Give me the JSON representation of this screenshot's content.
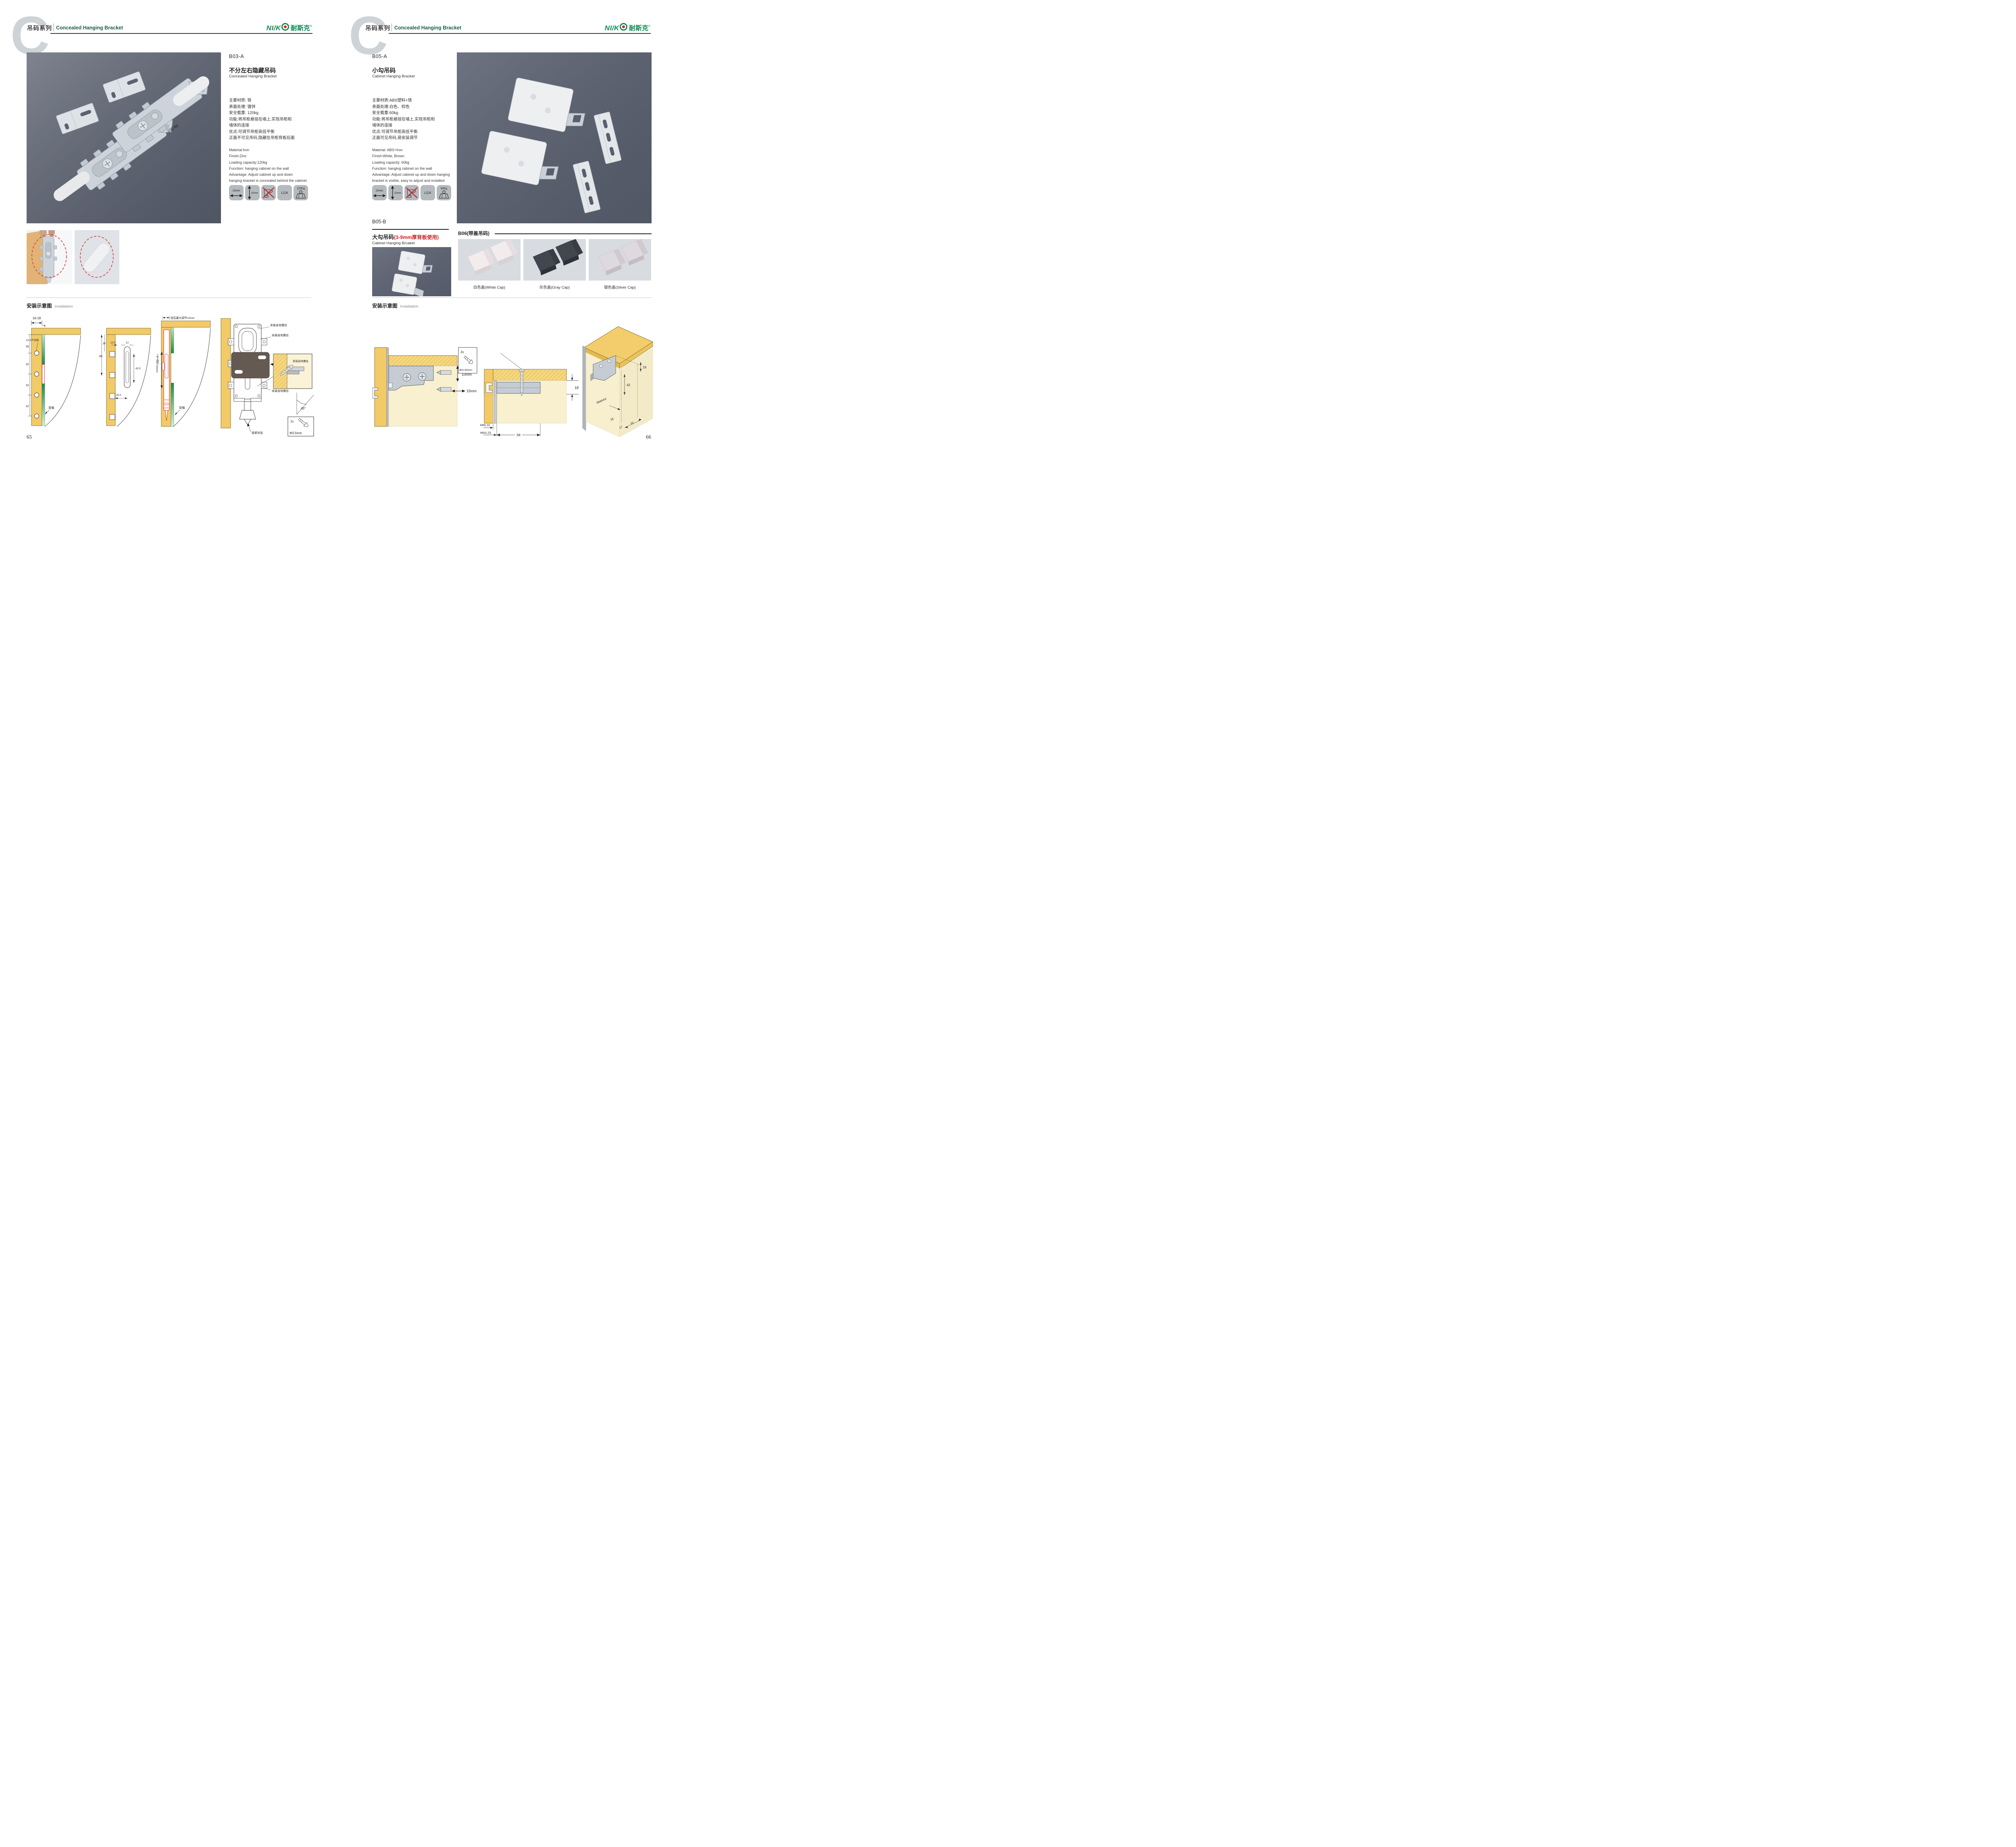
{
  "header": {
    "letter": "C",
    "series_cn": "吊码系列",
    "series_en": "Concealed Hanging Bracket"
  },
  "brand": {
    "part_ni": "NI",
    "part_slash": "/",
    "part_k": "K",
    "part_cn": "耐斯克",
    "reg": "®"
  },
  "left_page": {
    "page_number": "65",
    "product": {
      "code": "B03-A",
      "name_cn": "不分左右隐藏吊码",
      "name_en": "Concealed Hanging Bracket",
      "specs_cn": [
        "主要材质: 铁",
        "表面处理: 镀锌",
        "安全载重: 120kg",
        "功能:将吊柜悬挂在墙上,实现吊柜和",
        "墙体的连接",
        "优点:可调节吊柜高低平衡",
        "正面不可见吊码,隐藏在吊柜背板后面"
      ],
      "specs_en": [
        "Material:Iron",
        "Finish:Zinc",
        "Loading capacity:120kg",
        "Function: hanging cabinet on the wall",
        "Advantage: Adjust cabinet up and down",
        "hanging bracket is concealed behind the cabinet"
      ],
      "photo_stamp": "100 kg"
    },
    "icons": {
      "width_label": "10mm",
      "height_label": "10mm",
      "lga_label": "LGA",
      "load_label": "120Kg"
    },
    "installation": {
      "title_cn": "安装示意图",
      "title_en": "Installation",
      "d1": {
        "dim_top": "16-18",
        "dim_5": "5",
        "dims_left": [
          "35",
          "32",
          "32",
          "32"
        ],
        "callout": "10-4个均布",
        "back_panel": "背板"
      },
      "d2": {
        "dim_60": "60",
        "dim_35": "35",
        "dim_125": "12.5",
        "dim_12": "12",
        "dim_425": "42.5",
        "dim_205": "20.5"
      },
      "d3": {
        "top_label": "前后最大调节10mm",
        "side_label": "上下调节10mm",
        "back_panel": "背板"
      },
      "d4": {
        "screw_label_1": "安装自攻螺丝",
        "screw_label_2": "安装自攻螺丝",
        "screw_label_3": "安装自攻螺丝",
        "plate_label": "专用挂片",
        "lock_label": "锁紧状态",
        "detail_label": "安装自攻螺丝",
        "angle": "45°",
        "qty": "1x",
        "size": "Φ3.5mm"
      }
    }
  },
  "right_page": {
    "page_number": "66",
    "product_a": {
      "code": "B05-A",
      "name_cn": "小勾吊码",
      "name_en": "Cabinet Hanging Bracket",
      "specs_cn": [
        "主要材质:ABS塑料+铁",
        "表面处理:白色、棕色",
        "安全载重:60kg",
        "功能:将吊柜悬挂在墙上,实现吊柜和",
        "墙体的连接",
        "优点:可调节吊柜高低平衡",
        "正面可见吊码,易安装调节"
      ],
      "specs_en": [
        "Material: ABS+Iron",
        "Finish:White, Brown",
        "Loading capacity: 60kg",
        "Function: hanging cabinet on the wall",
        "Advantage: Adjust cabinet up and down hanging",
        "bracket is visible, easy to adjust and installed"
      ]
    },
    "icons": {
      "width_label": "15mm",
      "height_label": "10mm",
      "lga_label": "LGA",
      "load_label": "60Kg"
    },
    "product_b": {
      "code": "B05-B",
      "name_cn": "大勾吊码",
      "name_note": "(3-9mm厚背板使用)",
      "name_en": "Cabinet Hanging Brcaket"
    },
    "product_b06": {
      "label": "B06(带盖吊码)",
      "caps": [
        {
          "label": "白色盖(White Cap)"
        },
        {
          "label": "灰色盖(Gray Cap)"
        },
        {
          "label": "银色盖(Silver Cap)"
        }
      ]
    },
    "installation": {
      "title_cn": "安装示意图",
      "title_en": "Installation",
      "d1": {
        "qty": "2x",
        "size": "Φ4×30mm",
        "v_adjust": "10mm",
        "h_adjust": "15mm"
      },
      "d2": {
        "dim_18": "18",
        "dim_min": "MIN.10",
        "dim_max": "MAX.23",
        "dim_58": "58"
      },
      "d3": {
        "dim_16_top": "16",
        "dim_42": "42",
        "dim_rmax": "RMAX4",
        "dim_16_bottom": "16",
        "dim_17": "17",
        "dim_32": "32"
      }
    }
  },
  "colors": {
    "brand_green": "#0d8a52",
    "header_green": "#1b5e45",
    "accent_red": "#c9252b",
    "photo_bg_dark": "#5b6171",
    "photo_bg_light": "#dce0e5",
    "icon_bg": "#b5babe",
    "wood": "#f2ca67",
    "cream": "#f8f0cf",
    "bracket_gray": "#c5ccd3",
    "plate_brown": "#655a51",
    "letter_gray": "#ced3d7"
  }
}
